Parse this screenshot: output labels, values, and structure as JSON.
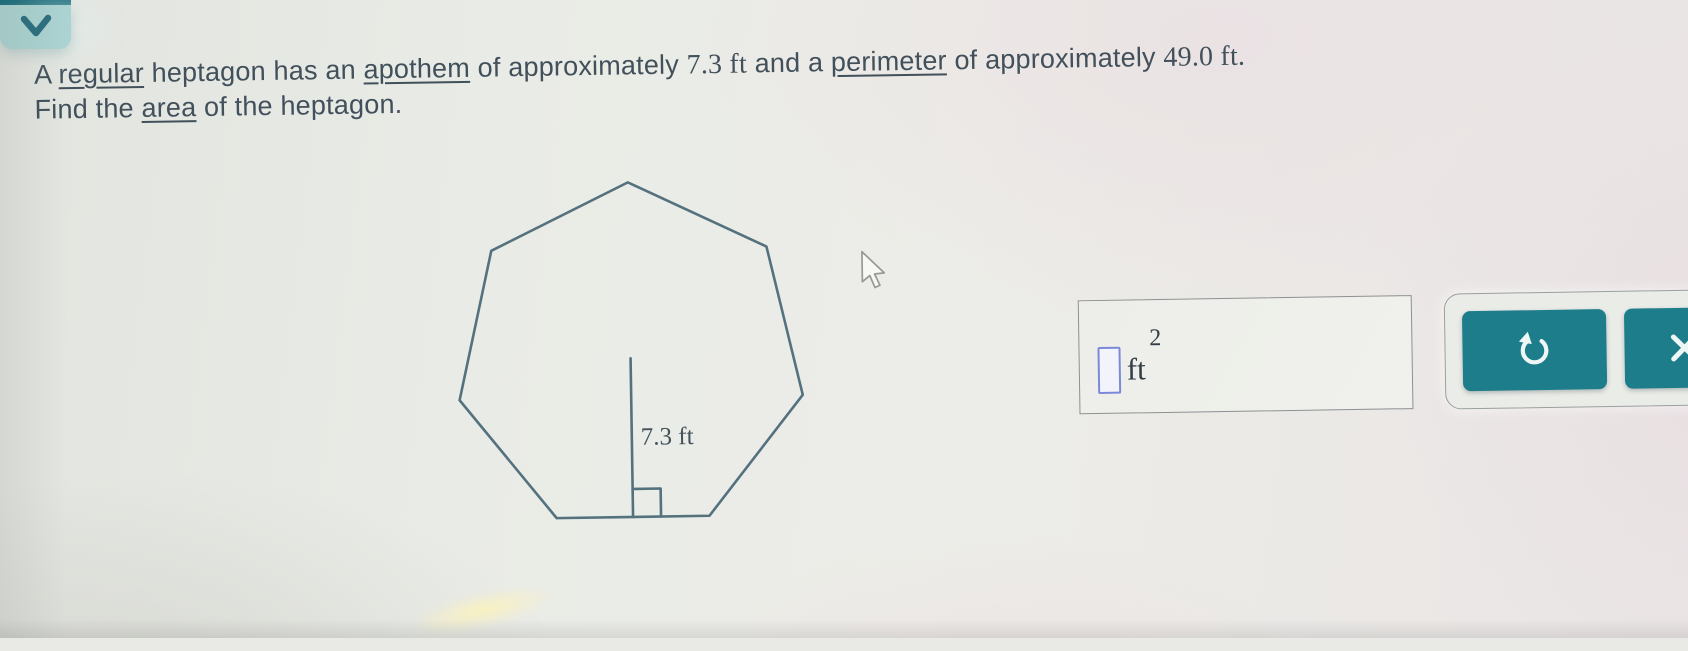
{
  "problem": {
    "line1": [
      {
        "t": "A "
      },
      {
        "t": "regular"
      },
      {
        "t": " heptagon has an "
      },
      {
        "t": "apothem"
      },
      {
        "t": " of approximately "
      },
      {
        "t": "7.3 ft"
      },
      {
        "t": " and a "
      },
      {
        "t": "perimeter"
      },
      {
        "t": " of approximately "
      },
      {
        "t": "49.0 ft."
      }
    ],
    "line2": [
      {
        "t": "Find the "
      },
      {
        "t": "area"
      },
      {
        "t": " of the heptagon."
      }
    ]
  },
  "figure": {
    "shape": "regular-heptagon",
    "sides": 7,
    "apothem_label": "7.3 ft",
    "geometry": {
      "cx": 200,
      "cy": 198,
      "r": 176,
      "right_angle_size": 28
    },
    "stroke": "#54717e"
  },
  "answer": {
    "value": "",
    "unit": "ft",
    "exponent": "2"
  },
  "toolbar": {
    "undo": "undo",
    "clear": "clear"
  },
  "collapse": {
    "icon": "chevron-down"
  },
  "colors": {
    "button_teal": "#1d7d8b",
    "collapse_teal": "#abd3d1",
    "collapse_strip": "#186d7c",
    "text": "#41505a",
    "figure_stroke": "#54717e",
    "input_border": "#7c89da",
    "background": "#e9eae5"
  }
}
